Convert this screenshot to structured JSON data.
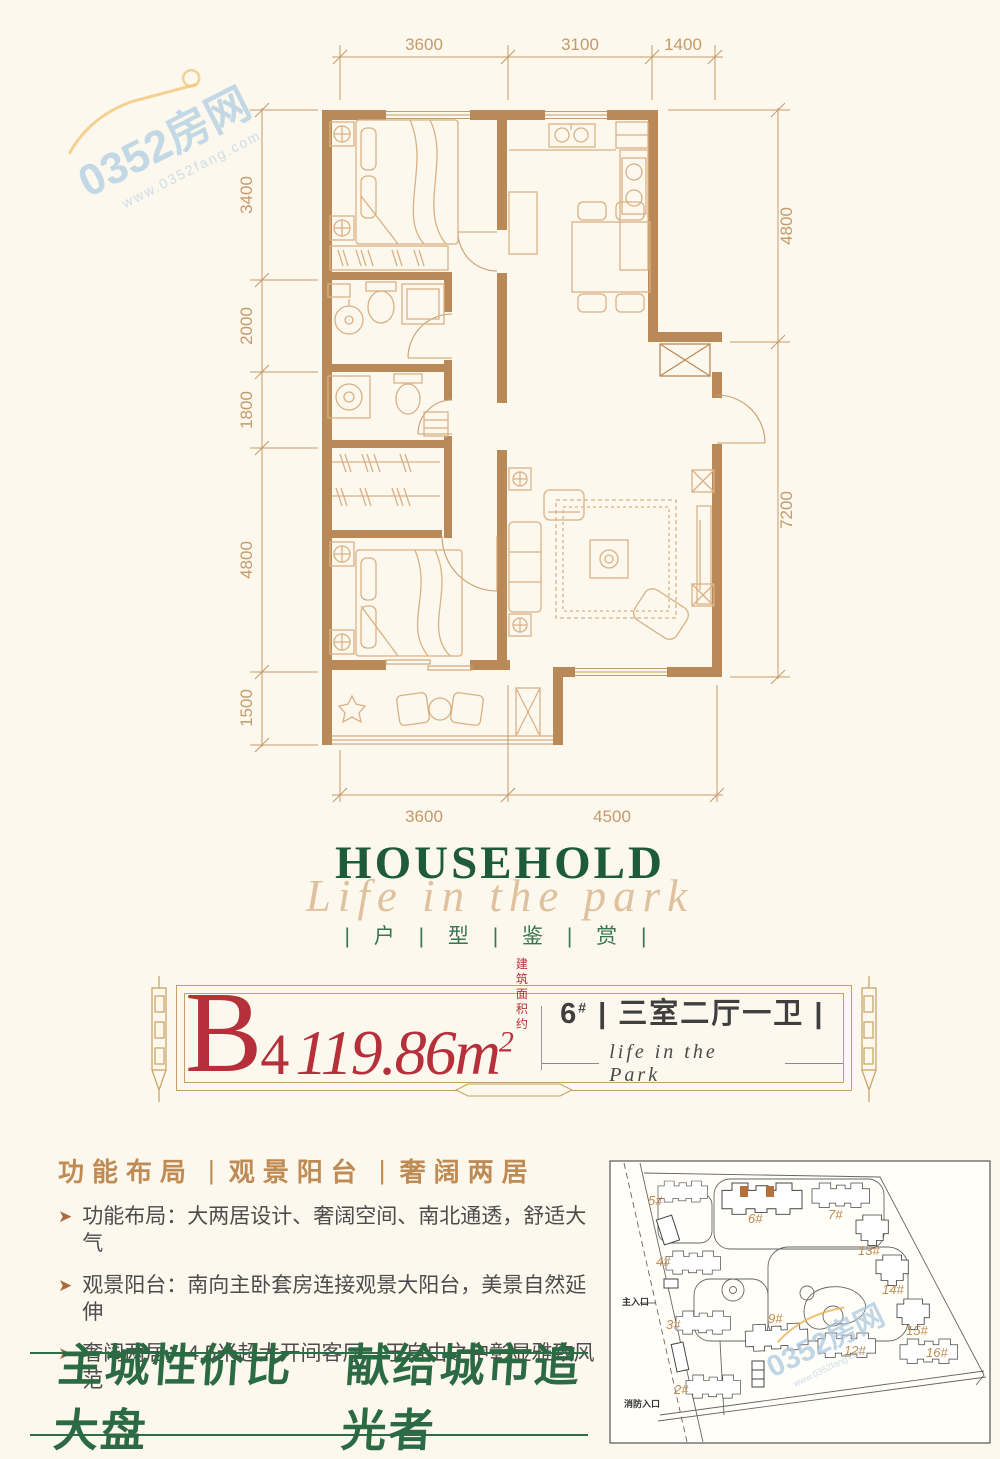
{
  "colors": {
    "background": "#fcf8ed",
    "wall": "#b98a58",
    "furniture_line": "#d9b185",
    "dim_line": "#c49a6a",
    "title_green": "#1d5b3a",
    "script_tan": "#dcb890",
    "red": "#b5303a",
    "feature_tan": "#bf8b55",
    "slogan_green": "#2b6a43",
    "watermark_blue": "#b9d3e4"
  },
  "watermark": {
    "brand": "0352房网",
    "url": "www.0352fang.com"
  },
  "floorplan": {
    "dims_top": [
      "3600",
      "3100",
      "1400"
    ],
    "dims_left": [
      "3400",
      "2000",
      "1800",
      "4800",
      "1500"
    ],
    "dims_right": [
      "4800",
      "7200"
    ],
    "dims_bottom": [
      "3600",
      "4500"
    ]
  },
  "title": {
    "en": "HOUSEHOLD",
    "script": "Life in the park",
    "cn": "| 户 | 型 | 鉴 | 赏 |"
  },
  "banner": {
    "unit_letter": "B",
    "unit_number": "4",
    "area_value": "119.86m",
    "area_sup": "2",
    "area_note_line1": "建筑",
    "area_note_line2": "面积约",
    "building_no": "6",
    "building_sup": "#",
    "layout": "| 三室二厅一卫 |",
    "tagline": "life in the Park"
  },
  "features": {
    "divider": "|",
    "bullet": "➤",
    "headings": [
      "功能布局",
      "观景阳台",
      "奢阔两居"
    ],
    "items": [
      "功能布局：大两居设计、奢阔空间、南北通透，舒适大气",
      "观景阳台：南向主卧套房连接观景大阳台，美景自然延伸",
      "奢阔两居：4.5米超大开间客厅，于自由之中彰显雅致风范"
    ]
  },
  "slogan": {
    "left": "主城性价比大盘",
    "right": "献给城市追光者"
  },
  "sitemap": {
    "entrance_main": "主入口",
    "entrance_fire": "消防入口",
    "buildings": [
      "5#",
      "6#",
      "7#",
      "13#",
      "14#",
      "15#",
      "16#",
      "12#",
      "9#",
      "4#",
      "3#",
      "2#"
    ],
    "watermark_brand": "0352房网",
    "watermark_url": "www.0352fang.com"
  }
}
